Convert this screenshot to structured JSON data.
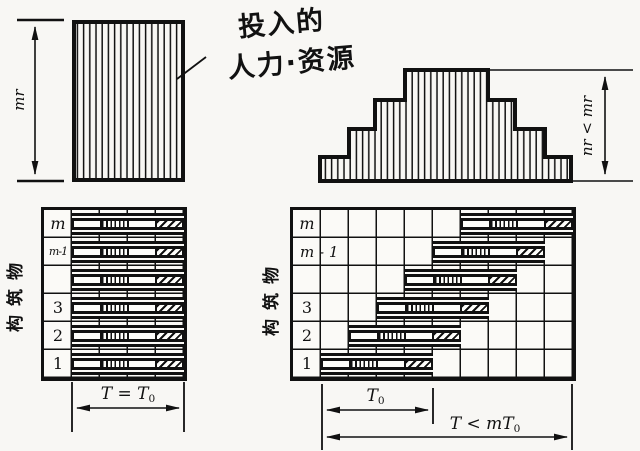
{
  "figure": {
    "background": "#f8f7f4",
    "ink": "#111111"
  },
  "top_section": {
    "uniform_height_label": "mr",
    "stepped_height_label": "nr < mr",
    "annotation": {
      "line1": "投入的",
      "line2": "人力·资源"
    }
  },
  "left_gantt": {
    "axis_label": "构筑物",
    "columns": 4,
    "bar_span": 4,
    "segments": [
      "plain",
      "stripes",
      "plain",
      "hatch"
    ],
    "rows": [
      {
        "label": "m",
        "start": 1
      },
      {
        "label": "m-1",
        "start": 1
      },
      {
        "label": "",
        "start": 1
      },
      {
        "label": "3",
        "start": 1
      },
      {
        "label": "2",
        "start": 1
      },
      {
        "label": "1",
        "start": 1
      }
    ],
    "duration_label": {
      "pre": "T = T",
      "sub": "0"
    }
  },
  "right_gantt": {
    "axis_label": "构筑物",
    "columns": 9,
    "bar_span": 4,
    "segments": [
      "plain",
      "stripes",
      "plain",
      "hatch"
    ],
    "rows": [
      {
        "label": "m",
        "start": 6
      },
      {
        "label": "m - 1",
        "start": 5
      },
      {
        "label": "",
        "start": 4
      },
      {
        "label": "3",
        "start": 3
      },
      {
        "label": "2",
        "start": 2
      },
      {
        "label": "1",
        "start": 1
      }
    ],
    "cycle_label": {
      "pre": "T",
      "sub": "0"
    },
    "total_label": {
      "pre": "T < mT",
      "sub": "0"
    }
  }
}
